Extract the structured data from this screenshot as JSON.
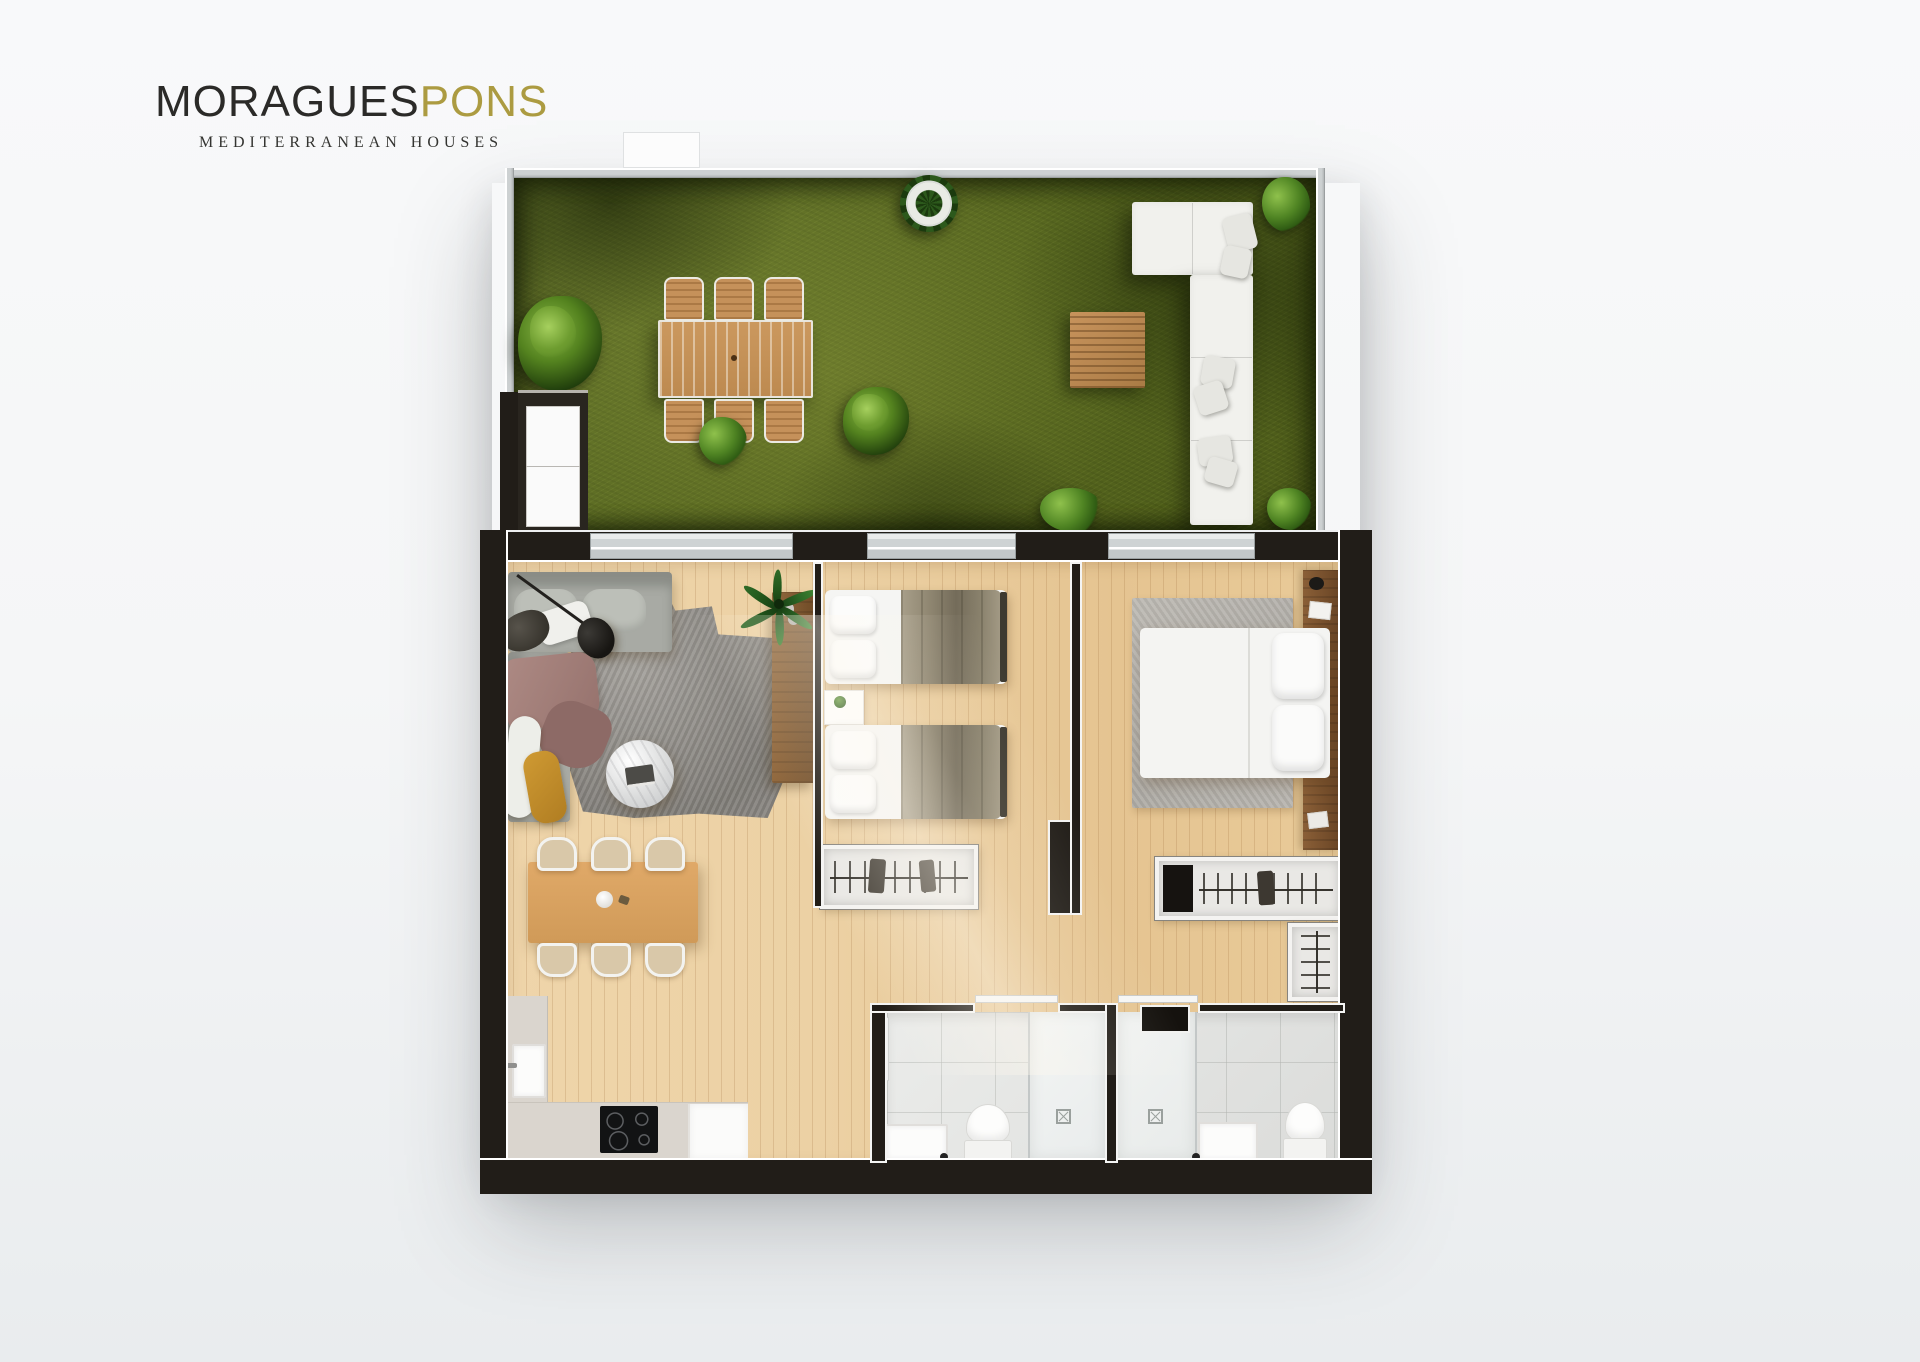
{
  "brand": {
    "name_primary": "MORAGUES",
    "name_secondary": "PONS",
    "tagline": "MEDITERRANEAN HOUSES",
    "text_color": "#2b2a28",
    "accent_gold": "#ac9b41"
  },
  "scene": {
    "type": "apartment floor plan, photorealistic top-down 3D render",
    "areas": [
      "terrace-garden",
      "living-dining-area",
      "kitchen",
      "twin-bedroom",
      "master-bedroom",
      "bathroom-1",
      "bathroom-2",
      "hallway"
    ],
    "objects": [
      "outdoor-dining-table-with-6-chairs",
      "outdoor-corner-sofa",
      "outdoor-coffee-table",
      "garden-bushes",
      "potted-plant",
      "storage-cabinet",
      "gray-corner-sofa-with-chaise",
      "floor-lamp",
      "shaggy-area-rug",
      "round-marble-coffee-table",
      "palm-plant",
      "wood-sideboard",
      "dining-table-with-6-chairs",
      "kitchen-counter",
      "kitchen-sink",
      "induction-cooktop",
      "twin-bed",
      "twin-bed",
      "nightstand",
      "open-wardrobe-with-hangers",
      "double-bed",
      "wood-headboard",
      "master-wardrobe",
      "shoe-closet",
      "walk-in-shower",
      "toilet",
      "washbasin-vanity",
      "sliding-glass-doors"
    ]
  },
  "palette": {
    "background": "#f4f6f7",
    "grass": "#5a6a20",
    "wood_floor": "#e9cd9e",
    "wall_dark": "#211d18",
    "wall_light": "#cdd1d2",
    "sofa_gray": "#a8aaa4",
    "pillow_yellow": "#c08a2b",
    "blanket_olive": "#8e8570",
    "tile_white": "#ebecea"
  }
}
